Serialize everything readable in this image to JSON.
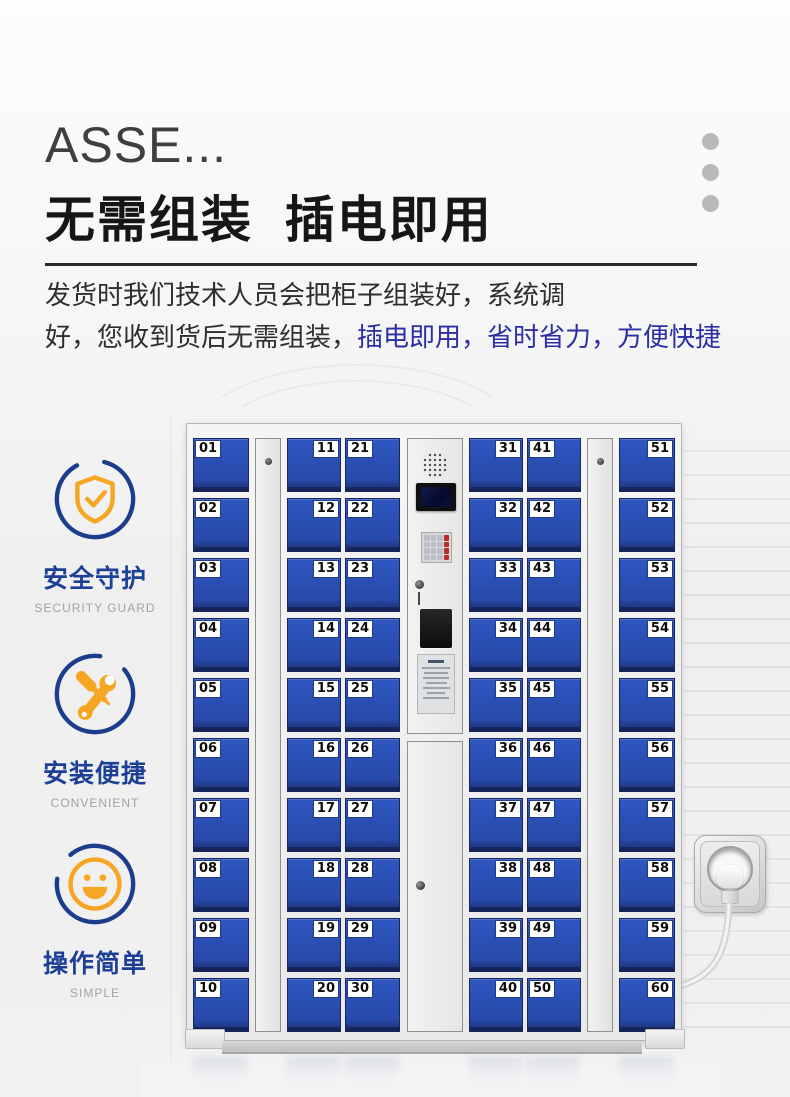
{
  "header": {
    "title_en": "ASSE...",
    "title_zh": "无需组装  插电即用",
    "dots_color": "#b9b9b9"
  },
  "intro": {
    "line1": "发货时我们技术人员会把柜子组装好，系统调",
    "line2_dark": "好，您收到货后无需组装，",
    "line2_blue": "插电即用，省时省力，方便快捷",
    "highlight_color": "#2b2fa3"
  },
  "features": [
    {
      "icon": "shield-check-icon",
      "title": "安全守护",
      "subtitle": "SECURITY GUARD"
    },
    {
      "icon": "wrench-screwdriver-icon",
      "title": "安装便捷",
      "subtitle": "CONVENIENT"
    },
    {
      "icon": "smile-icon",
      "title": "操作简单",
      "subtitle": "SIMPLE"
    }
  ],
  "colors": {
    "brand_blue": "#1d3f96",
    "accent_orange": "#f5a623",
    "door_blue": "#2b52b8"
  },
  "locker": {
    "door_color": "#2b52b8",
    "columns": [
      {
        "number_side": "left",
        "numbers": [
          "01",
          "02",
          "03",
          "04",
          "05",
          "06",
          "07",
          "08",
          "09",
          "10"
        ]
      },
      {
        "number_side": "right",
        "numbers": [
          "11",
          "12",
          "13",
          "14",
          "15",
          "16",
          "17",
          "18",
          "19",
          "20"
        ]
      },
      {
        "number_side": "left",
        "numbers": [
          "21",
          "22",
          "23",
          "24",
          "25",
          "26",
          "27",
          "28",
          "29",
          "30"
        ]
      },
      {
        "number_side": "right",
        "numbers": [
          "31",
          "32",
          "33",
          "34",
          "35",
          "36",
          "37",
          "38",
          "39",
          "40"
        ]
      },
      {
        "number_side": "left",
        "numbers": [
          "41",
          "42",
          "43",
          "44",
          "45",
          "46",
          "47",
          "48",
          "49",
          "50"
        ]
      },
      {
        "number_side": "right",
        "numbers": [
          "51",
          "52",
          "53",
          "54",
          "55",
          "56",
          "57",
          "58",
          "59",
          "60"
        ]
      }
    ]
  }
}
